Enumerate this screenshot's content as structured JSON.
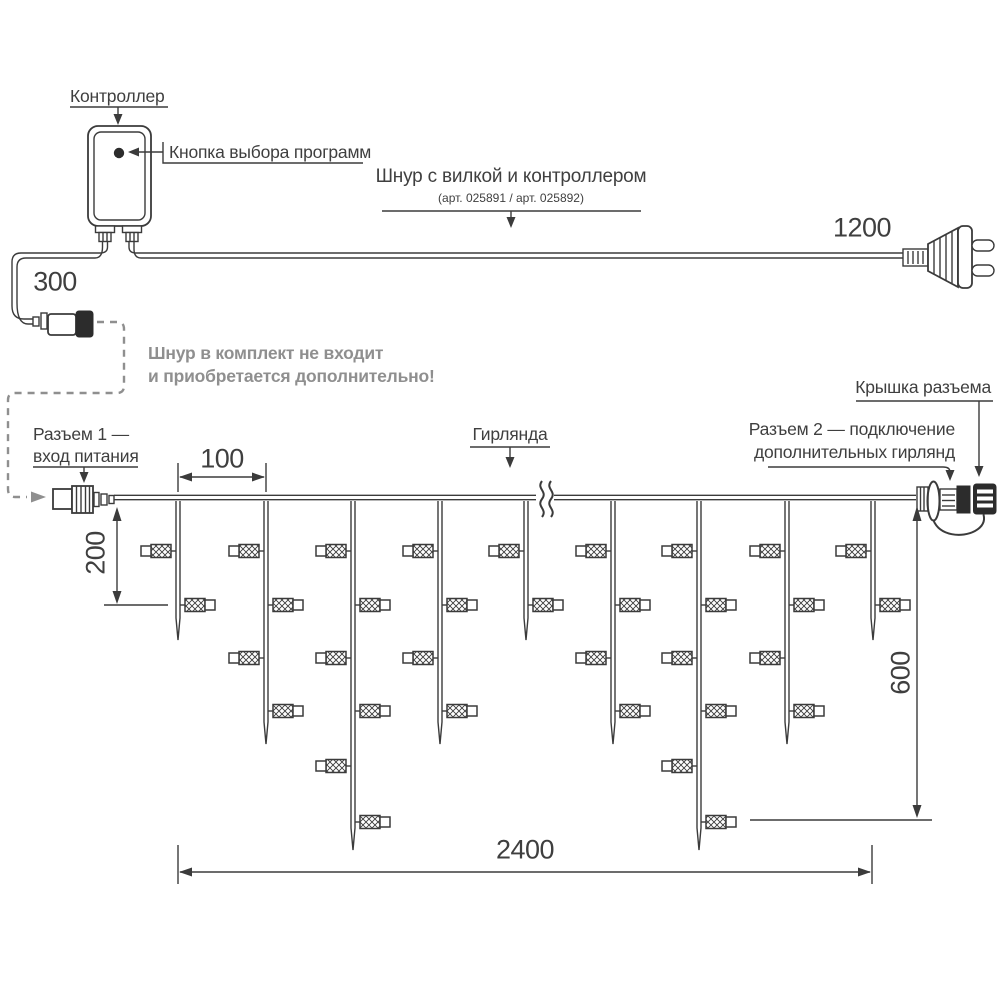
{
  "labels": {
    "controller": "Контроллер",
    "program_button": "Кнопка выбора программ",
    "cord_title": "Шнур с вилкой и контроллером",
    "cord_articles": "(арт. 025891 / арт. 025892)",
    "not_included_line1": "Шнур в комплект не входит",
    "not_included_line2": "и приобретается дополнительно!",
    "connector1_line1": "Разъем 1 —",
    "connector1_line2": "вход питания",
    "garland": "Гирлянда",
    "connector2_line1": "Разъем 2 — подключение",
    "connector2_line2": "дополнительных гирлянд",
    "connector_cap": "Крышка разъема"
  },
  "dimensions": {
    "plug_cord_length": "1200",
    "controller_cord_length": "300",
    "drop_spacing": "100",
    "short_drop_height": "200",
    "max_drop_height": "600",
    "garland_length": "2400"
  },
  "colors": {
    "line": "#3b3b3b",
    "muted": "#8f8f8f",
    "dark_fill": "#2c2c2c",
    "background": "#ffffff"
  },
  "diagram": {
    "garland": {
      "wire_y": 497.5,
      "start_x": 114,
      "end_x": 916,
      "break_x": 545,
      "lamp_rows_y": [
        551,
        605,
        658,
        711,
        766,
        822
      ],
      "drops": [
        {
          "x": 178,
          "lamps": 2,
          "tip": 640
        },
        {
          "x": 266,
          "lamps": 4,
          "tip": 744
        },
        {
          "x": 353,
          "lamps": 6,
          "tip": 850
        },
        {
          "x": 440,
          "lamps": 4,
          "tip": 744
        },
        {
          "x": 526,
          "lamps": 2,
          "tip": 640
        },
        {
          "x": 613,
          "lamps": 4,
          "tip": 744
        },
        {
          "x": 699,
          "lamps": 6,
          "tip": 850
        },
        {
          "x": 787,
          "lamps": 4,
          "tip": 744
        },
        {
          "x": 873,
          "lamps": 2,
          "tip": 640
        }
      ]
    }
  }
}
